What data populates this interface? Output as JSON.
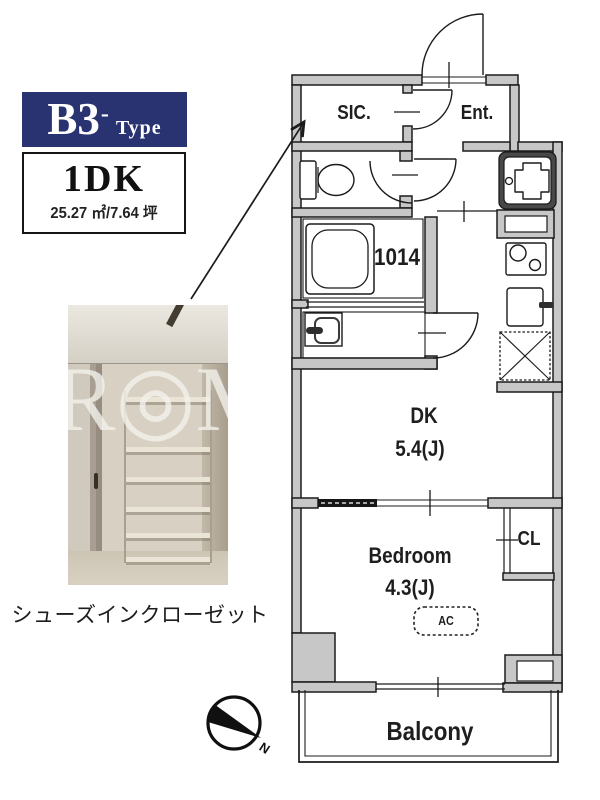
{
  "palette": {
    "navy": "#293371",
    "wall_gray": "#c7c7c7",
    "line": "#1b1b1b"
  },
  "type_badge": {
    "name": "B3",
    "hyphen": "-",
    "suffix": "Type"
  },
  "unit_info": {
    "layout": "1DK",
    "area": "25.27 ㎡/7.64 坪"
  },
  "photo": {
    "watermark": "R◎M",
    "caption": "シューズインクローゼット"
  },
  "plan": {
    "rooms": [
      {
        "label": "SIC."
      },
      {
        "label": "Ent."
      },
      {
        "label": "1014"
      },
      {
        "label": "DK",
        "size": "5.4(J)"
      },
      {
        "label": "Bedroom",
        "size": "4.3(J)"
      },
      {
        "label": "CL"
      },
      {
        "label": "AC"
      },
      {
        "label": "Balcony"
      }
    ],
    "compass_label": "N"
  }
}
